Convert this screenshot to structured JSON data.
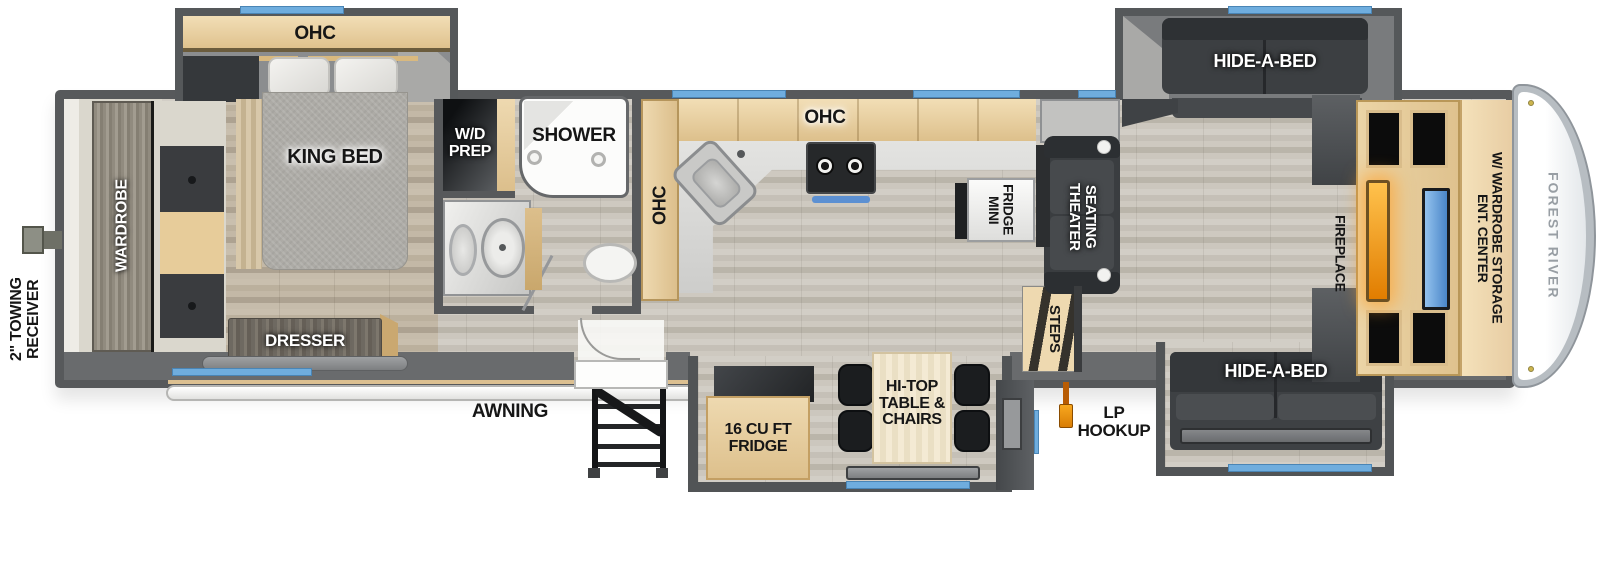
{
  "labels": {
    "towing_receiver": "2\" TOWING\nRECEIVER",
    "wardrobe": "WARDROBE",
    "ohc_bedroom": "OHC",
    "king_bed": "KING BED",
    "wd_prep": "W/D\nPREP",
    "shower": "SHOWER",
    "ohc_hall": "OHC",
    "ohc_kitchen": "OHC",
    "mini_fridge": "MINI\nFRIDGE",
    "theater_seating": "THEATER\nSEATING",
    "steps": "STEPS",
    "hide_a_bed_top": "HIDE-A-BED",
    "hide_a_bed_bottom": "HIDE-A-BED",
    "fireplace": "FIREPLACE",
    "ent_center": "ENT. CENTER\nW/ WARDROBE STORAGE",
    "forest_river": "FOREST RIVER",
    "lp_hookup": "LP\nHOOKUP",
    "fridge": "16 CU FT\nFRIDGE",
    "hi_top_table": "HI-TOP\nTABLE &\nCHAIRS",
    "dresser": "DRESSER",
    "awning": "AWNING"
  },
  "colors": {
    "wall_gray": "#57595b",
    "window_blue": "#6fadde",
    "cabinet_tan": "#e9d4aa",
    "fireplace_orange": "#f09a12",
    "tv_blue": "#5a9ad8",
    "lp_orange": "#e8820c"
  }
}
